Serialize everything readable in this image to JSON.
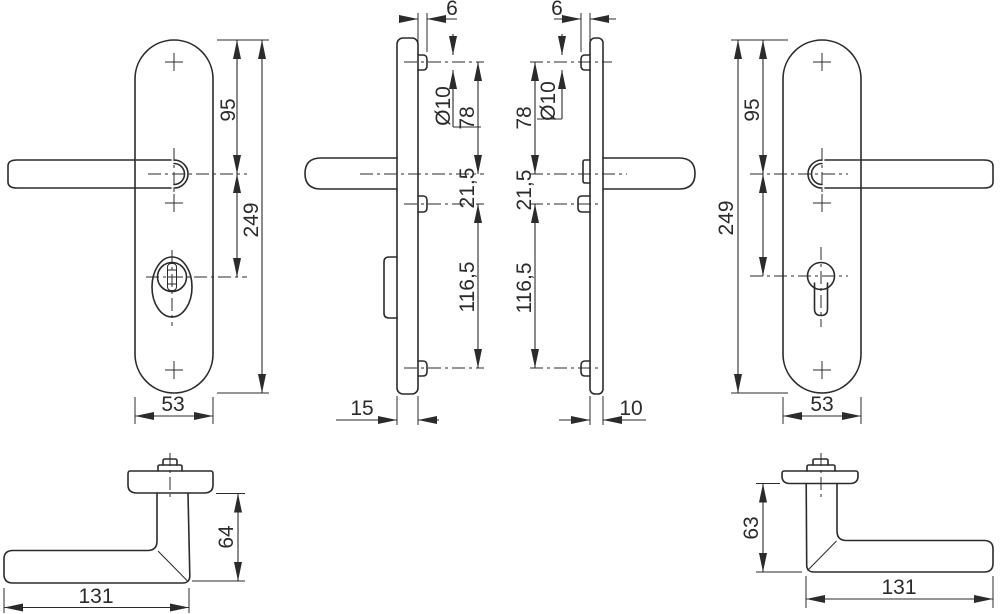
{
  "drawing": {
    "type": "technical-dimension-drawing",
    "background": "#ffffff",
    "line_color": "#2b2b2b",
    "views": {
      "front_exterior": {
        "dims": {
          "handle_to_top": "95",
          "height": "249",
          "width": "53"
        }
      },
      "side_exterior": {
        "dims": {
          "boss_length": "6",
          "boss_diameter": "Ø10",
          "top_screw_to_spindle": "78",
          "spindle_to_mid_screw": "21,5",
          "mid_to_bottom_screw": "116,5",
          "thickness": "15"
        }
      },
      "side_interior": {
        "dims": {
          "boss_length": "6",
          "boss_diameter": "Ø10",
          "top_screw_to_spindle": "78",
          "spindle_to_mid_screw": "21,5",
          "mid_to_bottom_screw": "116,5",
          "thickness": "10"
        }
      },
      "front_interior": {
        "dims": {
          "handle_to_top": "95",
          "height": "249",
          "width": "53"
        }
      },
      "lever_exterior": {
        "dims": {
          "length": "131",
          "height": "64"
        }
      },
      "lever_interior": {
        "dims": {
          "length": "131",
          "height": "63"
        }
      }
    }
  }
}
